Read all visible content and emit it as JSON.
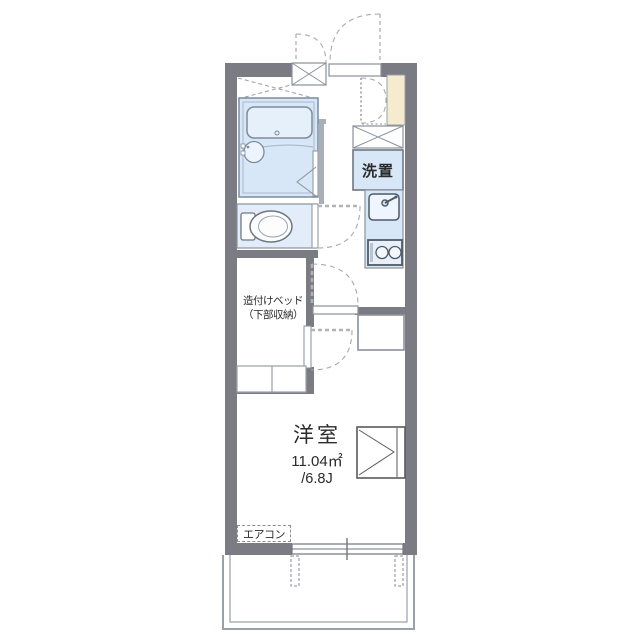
{
  "plan": {
    "type": "apartment-floorplan",
    "labels": {
      "washer": "洗置",
      "bed_line1": "造付けベッド",
      "bed_line2": "（下部収納）",
      "room_name": "洋室",
      "room_area_m2": "11.04㎡",
      "room_area_tatami": "/6.8J",
      "aircon": "エアコン"
    },
    "colors": {
      "wall": "#7b7b83",
      "fixture_fill": "#d8e7f7",
      "fixture_fill_light": "#e6f0fb",
      "toilet_room_fill": "#e3edf9",
      "cabinet_cream": "#f7ebcf",
      "line": "#8a919b",
      "dash_line": "#a9a9a9",
      "text": "#2b2b2b"
    }
  }
}
